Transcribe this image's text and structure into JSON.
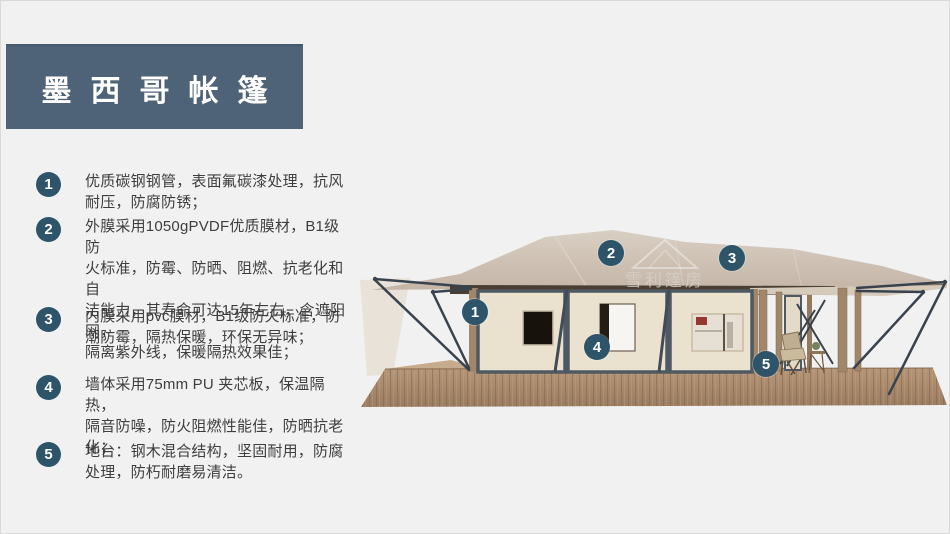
{
  "page": {
    "background": "#f1f1f2",
    "accent_color": "#4e6377",
    "badge_color": "#2d5468",
    "text_color": "#3e3e3e"
  },
  "title": {
    "text": "墨西哥帐篷"
  },
  "features": [
    {
      "num": "1",
      "text": "优质碳钢钢管，表面氟碳漆处理，抗风\n耐压，防腐防锈；"
    },
    {
      "num": "2",
      "text": "外膜采用1050gPVDF优质膜材，B1级防\n火标准，防霉、防晒、阻燃、抗老化和自\n洁能力，其寿命可达15年左右，含遮阳网，\n隔离紫外线，保暖隔热效果佳；"
    },
    {
      "num": "3",
      "text": "内膜采用pvc膜材，B1级防火标准，防\n潮防霉，隔热保暖，环保无异味；"
    },
    {
      "num": "4",
      "text": "墙体采用75mm PU 夹芯板，保温隔热，\n隔音防噪，防火阻燃性能佳，防晒抗老\n化；"
    },
    {
      "num": "5",
      "text": "地台：钢木混合结构，坚固耐用，防腐\n处理，防朽耐磨易清洁。"
    }
  ],
  "illustration": {
    "watermark_cn": "雪利篷房",
    "watermark_en": "XUELI TENT",
    "colors": {
      "roof_top": "#d9cfc3",
      "roof_bottom": "#c3b3a5",
      "wall": "#eae1ce",
      "frame": "#4e5963",
      "deck": "#a8896c",
      "rod": "#39434e"
    },
    "callouts": [
      {
        "num": "1",
        "x": 120,
        "y": 94
      },
      {
        "num": "2",
        "x": 256,
        "y": 35
      },
      {
        "num": "3",
        "x": 377,
        "y": 40
      },
      {
        "num": "4",
        "x": 242,
        "y": 129
      },
      {
        "num": "5",
        "x": 411,
        "y": 146
      }
    ]
  }
}
